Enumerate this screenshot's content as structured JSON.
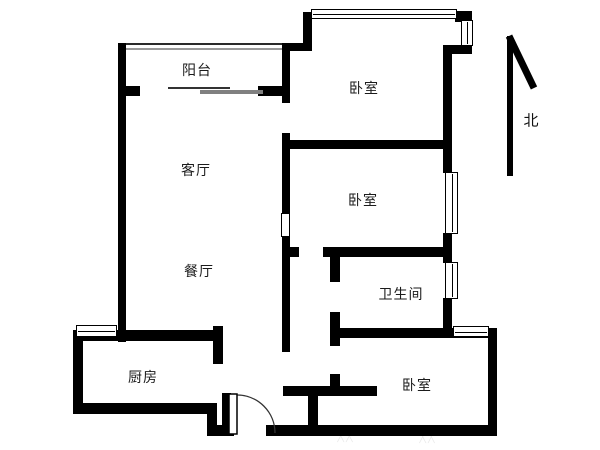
{
  "plan": {
    "title": "apartment-floor-plan",
    "background": "#ffffff",
    "wall_color": "#000000",
    "sliding_door_color": "#808080"
  },
  "rooms": [
    {
      "id": "balcony",
      "label": "阳台"
    },
    {
      "id": "living-room",
      "label": "客厅"
    },
    {
      "id": "dining-room",
      "label": "餐厅"
    },
    {
      "id": "kitchen",
      "label": "厨房"
    },
    {
      "id": "bedroom-north",
      "label": "卧室"
    },
    {
      "id": "bedroom-middle",
      "label": "卧室"
    },
    {
      "id": "bathroom",
      "label": "卫生间"
    },
    {
      "id": "bedroom-south",
      "label": "卧室"
    }
  ],
  "compass": {
    "label": "北"
  },
  "watermark": {
    "text": "╳╳"
  }
}
